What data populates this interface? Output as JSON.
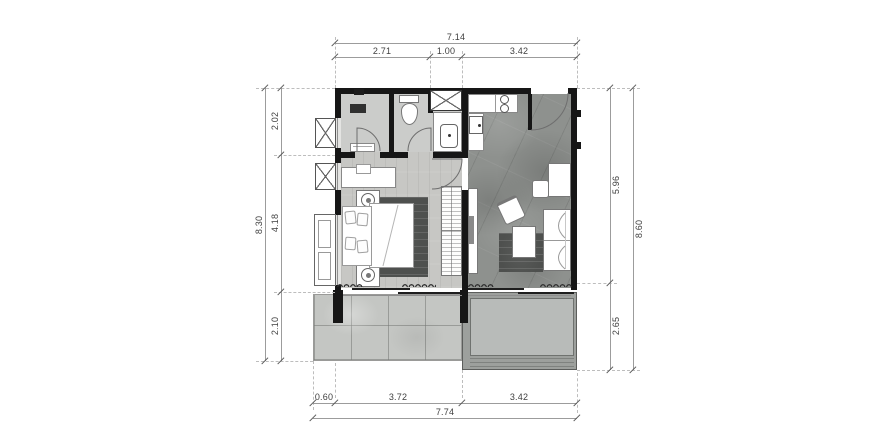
{
  "dimensions": {
    "top": {
      "overall": "7.14",
      "segments": [
        "2.71",
        "1.00",
        "3.42"
      ]
    },
    "bottom": {
      "overall": "7.74",
      "segments": [
        "0.60",
        "3.72",
        "3.42"
      ]
    },
    "left": {
      "overall": "8.30",
      "segments": [
        "2.02",
        "4.18",
        "2.10"
      ]
    },
    "right": {
      "overall": "8.60",
      "segments": [
        "5.96",
        "2.65"
      ]
    }
  },
  "colors": {
    "wall": "#161616",
    "dimension_line": "#9c9c9c",
    "dimension_text": "#3f3f3f",
    "bathroom_floor": "#cbccca",
    "bedroom_floor": "#c7c7c4",
    "living_floor": "#8e918e",
    "terrace_floor": "#c4c6c3",
    "pool_water": "#b8bbb9",
    "rug": "#4e504e",
    "furniture_fill": "#ffffff",
    "furniture_stroke": "#7a7a7a"
  }
}
